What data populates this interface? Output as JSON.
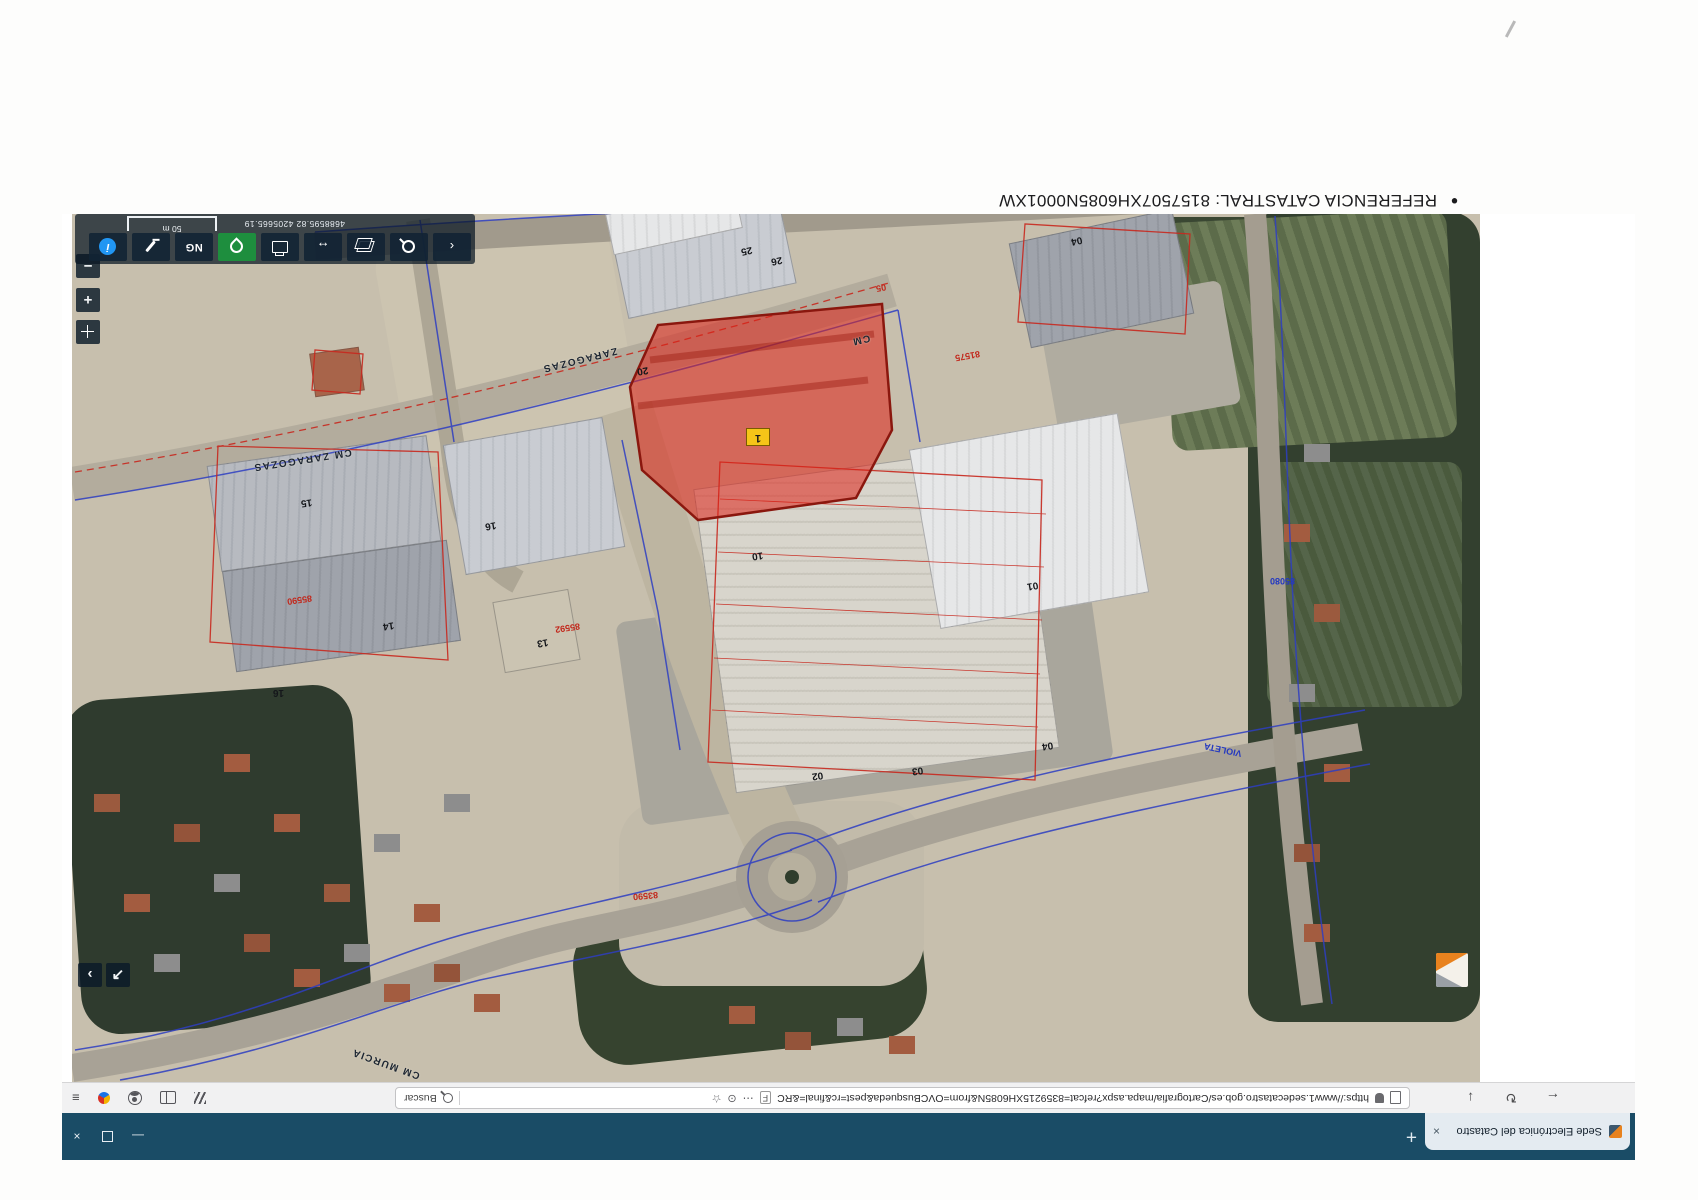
{
  "heading": {
    "bullet": "•",
    "text": "REFERENCIA CATASTRAL: 8157507XH6085N0001XW"
  },
  "browser": {
    "tab": {
      "title": "Sede Electrónica del Catastro",
      "close_glyph": "×"
    },
    "new_tab_glyph": "+",
    "window": {
      "minimize_glyph": "—",
      "close_glyph": "×"
    },
    "nav": {
      "back_glyph": "←",
      "reload_glyph": "↻",
      "download_glyph": "↓"
    },
    "address": {
      "url": "https://www1.sedecatastro.gob.es/Cartografia/mapa.aspx?refcat=8359215XH6085N&from=OVCBusqueda&pest=rc&final=&RC",
      "f_badge": "F",
      "more_glyph": "⋯",
      "target_glyph": "⊙",
      "star_glyph": "☆",
      "search_label": "Buscar"
    },
    "chrome_right": {
      "menu_glyph": "≡"
    }
  },
  "map": {
    "parcel_badge": "1",
    "scale_label": "50 m",
    "coordinates": "4688595.82   4205665.19",
    "controls": {
      "collapse_glyph": "‹",
      "measure_glyph": "↔",
      "ng_label": "NG",
      "info_glyph": "i",
      "zoom_in_glyph": "+",
      "zoom_out_glyph": "−",
      "expand_glyph": "↗",
      "chevron_glyph": "›"
    },
    "labels": [
      "CM ZARAGOZAS",
      "ZARAGOZAS",
      "CM",
      "CM MURCIA",
      "VIOLETA",
      "85592",
      "85590",
      "81575",
      "83590",
      "85080",
      "15",
      "16",
      "14",
      "13",
      "16",
      "10",
      "01",
      "02",
      "03",
      "04",
      "04",
      "25",
      "26",
      "20",
      "05"
    ]
  }
}
